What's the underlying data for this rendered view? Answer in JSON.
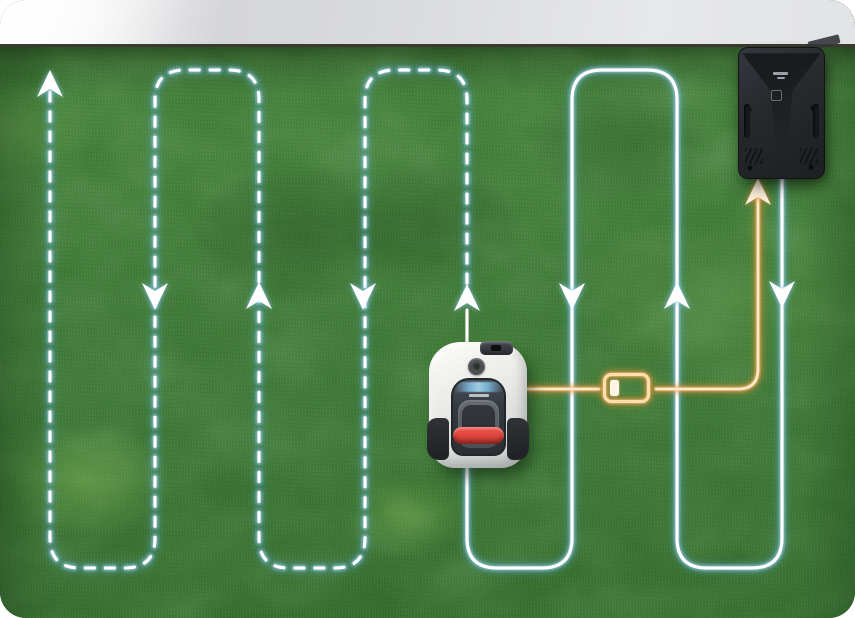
{
  "scene": {
    "title": "Aerial illustration of a robotic lawn mower mowing a lawn in a serpentine pattern",
    "view": "top-down lawn with paved edge at top",
    "canvas": {
      "width": 855,
      "height": 618,
      "corner_radius": 26
    }
  },
  "colors": {
    "grass_base": "#39702f",
    "grass_light_patch": "#4e8a3a",
    "grass_dark_patch": "#2b5626",
    "path_core": "#ffffff",
    "path_glow": "#8ccaf2",
    "return_core": "#fff1dc",
    "return_glow": "#ef9440",
    "patio": "#dcdde0",
    "patio_edge": "#3b3a31",
    "station_body": "#26282c",
    "mower_body": "#e9eae7",
    "mower_bumper": "#e04840",
    "mower_panel": "#2f3337"
  },
  "elements": {
    "patio_edge": {
      "label": "paved edge strip"
    },
    "charging_station": {
      "label": "charging station dock"
    },
    "robot_mower": {
      "label": "robotic lawn mower (top view)"
    },
    "battery_icon": {
      "label": "low battery indicator",
      "level_percent": 25
    }
  },
  "icons": {
    "battery": "battery-outline-low",
    "arrowheads": "concave-chevron"
  },
  "routes": {
    "traveled": {
      "style": "solid glowing blue-white line",
      "description": "path already mowed, from charging station to mower",
      "columns_x": [
        782,
        677,
        572,
        467
      ]
    },
    "planned": {
      "style": "dashed glowing blue-white line",
      "description": "upcoming serpentine mowing path ahead of mower",
      "columns_x": [
        467,
        363,
        259,
        155,
        50
      ]
    },
    "return": {
      "style": "solid glowing orange line",
      "description": "direct return route from mower through low-battery icon up to charging station"
    },
    "arrows": [
      {
        "x": 50,
        "tip_y": 70,
        "dir": "up",
        "route": "planned"
      },
      {
        "x": 155,
        "tip_y": 310,
        "dir": "down",
        "route": "planned"
      },
      {
        "x": 259,
        "tip_y": 282,
        "dir": "up",
        "route": "planned"
      },
      {
        "x": 363,
        "tip_y": 310,
        "dir": "down",
        "route": "planned"
      },
      {
        "x": 467,
        "tip_y": 284,
        "dir": "up",
        "route": "traveled"
      },
      {
        "x": 572,
        "tip_y": 310,
        "dir": "down",
        "route": "traveled"
      },
      {
        "x": 677,
        "tip_y": 282,
        "dir": "up",
        "route": "traveled"
      },
      {
        "x": 782,
        "tip_y": 308,
        "dir": "down",
        "route": "traveled"
      },
      {
        "x": 758,
        "tip_y": 178,
        "dir": "up",
        "route": "return"
      }
    ]
  }
}
